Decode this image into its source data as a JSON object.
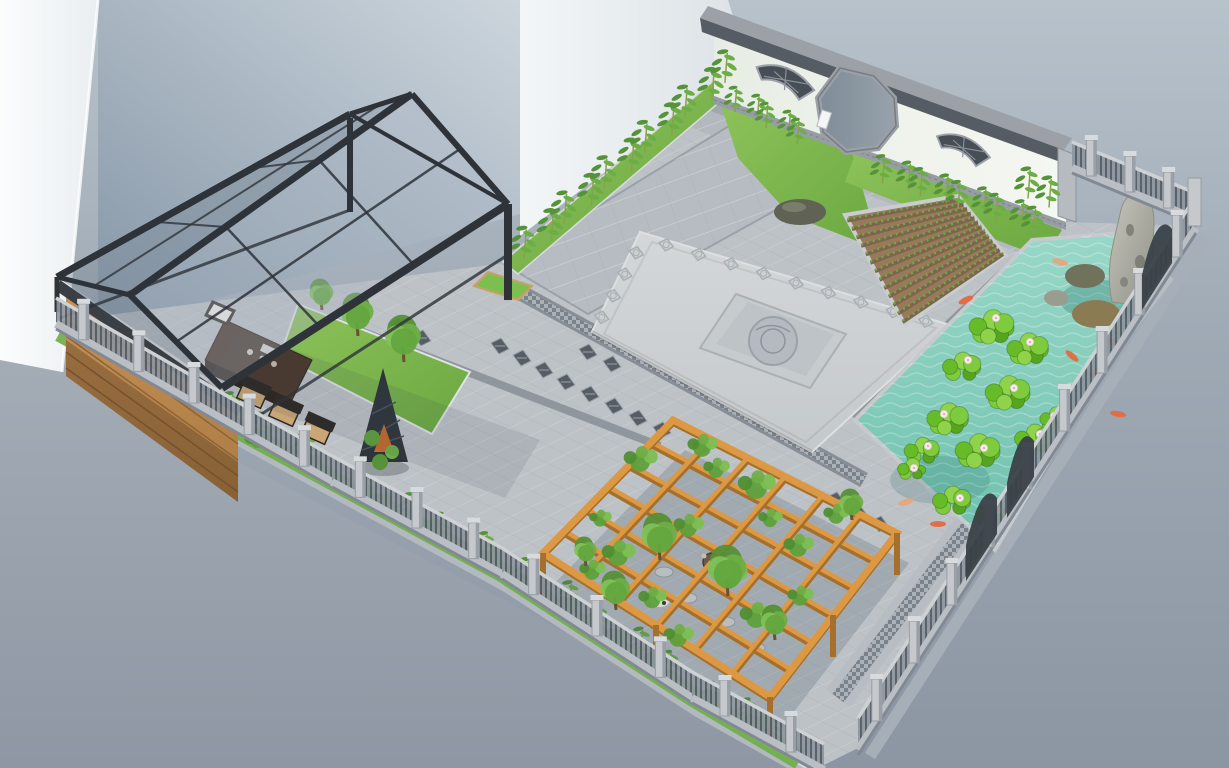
{
  "colors": {
    "sky_top": "#b8c2cb",
    "sky_bottom": "#8c96a3",
    "outside_ground": "#9aa3ae",
    "building_white": "#f4f8f8",
    "building_shade": "#8495a6",
    "building_light": "#edf1f3",
    "wall_white": "#eef3ec",
    "wall_coping": "#565c63",
    "wall_coping_top": "#9ba1a6",
    "brick_base": "#969da3",
    "window_lattice_dark": "#474e56",
    "gate_inner": "#8a96a2",
    "paving_base": "#bdc2c7",
    "paving_path": "#b3b9be",
    "paving_dark_band": "#878e96",
    "plaza_light": "#ced2d5",
    "medallion": "#b4bac0",
    "soil_brown": "#97795c",
    "seedling_green": "#6faa43",
    "grass_green": "#7cb94e",
    "grass_dark": "#55923a",
    "water_light": "#9ad8c8",
    "water_dark": "#6fc0ae",
    "lily_green": "#7ecb3d",
    "lily_dark": "#57a51f",
    "flower_white": "#f7f4ef",
    "flower_pink": "#eba7b5",
    "koi_orange": "#e06a40",
    "koi_pale": "#e8a57c",
    "rock_gray": "#b2b1a6",
    "rock_moss": "#70725c",
    "rock_brown": "#8a7b52",
    "fence_post": "#c5c9cd",
    "fence_infill": "#8d959e",
    "fence_rail": "#ced2d5",
    "fence_panel_dark": "#3a4148",
    "pergola_wood": "#dc9843",
    "pergola_wood_dark": "#a5702c",
    "vine_green": "#5fa03c",
    "tree_green": "#6fae47",
    "canopy_frame": "#2e3339",
    "wood_wall": "#c08b55",
    "wood_slat": "#8e6336",
    "table_brown": "#4a382b",
    "cushion_tan": "#c9a674",
    "bamboo_leaf": "#6cae45",
    "bamboo_leaf2": "#55923a",
    "bamboo_stem": "#8aa04f",
    "cone_trellis": "#2e343a",
    "cone_orange": "#c56a2b"
  },
  "scene_elements": {
    "bamboo_strips": [
      {
        "from": [
          517,
          268
        ],
        "to": [
          738,
          74
        ],
        "n": 11,
        "s": 1.15
      },
      {
        "from": [
          730,
          108
        ],
        "to": [
          808,
          148
        ],
        "n": 5,
        "s": 0.9
      },
      {
        "from": [
          876,
          180
        ],
        "to": [
          1046,
          238
        ],
        "n": 9,
        "s": 1.0
      },
      {
        "from": [
          1024,
          194
        ],
        "to": [
          1052,
          212
        ],
        "n": 2,
        "s": 1.1
      },
      {
        "from": [
          96,
          352
        ],
        "to": [
          320,
          474
        ],
        "n": 6,
        "s": 1.1
      },
      {
        "from": [
          350,
          492
        ],
        "to": [
          500,
          570
        ],
        "n": 4,
        "s": 1.0
      },
      {
        "from": [
          512,
          576
        ],
        "to": [
          690,
          692
        ],
        "n": 5,
        "s": 1.05
      },
      {
        "from": [
          700,
          700
        ],
        "to": [
          788,
          750
        ],
        "n": 3,
        "s": 0.95
      }
    ],
    "shrubs": [
      [
        140,
        380
      ],
      [
        200,
        414
      ],
      [
        258,
        446
      ],
      [
        308,
        470
      ],
      [
        378,
        508
      ],
      [
        428,
        534
      ],
      [
        468,
        556
      ],
      [
        528,
        590
      ],
      [
        568,
        612
      ],
      [
        618,
        644
      ],
      [
        658,
        668
      ],
      [
        718,
        706
      ],
      [
        758,
        730
      ],
      [
        360,
        500
      ],
      [
        488,
        566
      ],
      [
        96,
        360
      ]
    ],
    "trees": [
      [
        358,
        336,
        22
      ],
      [
        404,
        362,
        24
      ],
      [
        322,
        310,
        16
      ],
      [
        660,
        560,
        24
      ],
      [
        728,
        596,
        26
      ],
      [
        616,
        610,
        20
      ],
      [
        775,
        640,
        18
      ],
      [
        852,
        520,
        16
      ],
      [
        586,
        566,
        15
      ]
    ],
    "pergola": {
      "corners": [
        [
          673,
          420
        ],
        [
          897,
          533
        ],
        [
          770,
          697
        ],
        [
          543,
          553
        ]
      ],
      "cells": 6,
      "posts": [
        [
          543,
          553,
          46
        ],
        [
          770,
          697,
          44
        ],
        [
          897,
          533,
          42
        ],
        [
          656,
          625,
          44
        ],
        [
          833,
          615,
          42
        ]
      ]
    },
    "vines": [
      [
        640,
        462,
        18
      ],
      [
        702,
        448,
        16
      ],
      [
        756,
        488,
        20
      ],
      [
        688,
        528,
        16
      ],
      [
        618,
        556,
        18
      ],
      [
        728,
        578,
        20
      ],
      [
        798,
        548,
        16
      ],
      [
        836,
        516,
        14
      ],
      [
        756,
        618,
        18
      ],
      [
        678,
        638,
        16
      ],
      [
        592,
        572,
        14
      ],
      [
        716,
        470,
        14
      ],
      [
        652,
        600,
        15
      ],
      [
        800,
        598,
        14
      ],
      [
        770,
        520,
        13
      ],
      [
        600,
        520,
        12
      ]
    ],
    "lily_clusters": [
      [
        992,
        328,
        26
      ],
      [
        1028,
        350,
        24
      ],
      [
        962,
        368,
        22
      ],
      [
        1008,
        394,
        26
      ],
      [
        948,
        420,
        24
      ],
      [
        922,
        452,
        20
      ],
      [
        978,
        452,
        26
      ],
      [
        1034,
        440,
        22
      ],
      [
        952,
        502,
        22
      ],
      [
        992,
        514,
        18
      ],
      [
        912,
        470,
        16
      ],
      [
        1056,
        420,
        18
      ]
    ],
    "lily_flowers": [
      [
        996,
        318
      ],
      [
        1030,
        342
      ],
      [
        968,
        360
      ],
      [
        1014,
        388
      ],
      [
        944,
        414
      ],
      [
        928,
        446
      ],
      [
        984,
        448
      ],
      [
        1040,
        434
      ],
      [
        960,
        498
      ],
      [
        998,
        510
      ],
      [
        914,
        468
      ],
      [
        1054,
        416
      ]
    ],
    "koi": [
      [
        1060,
        262,
        15,
        1
      ],
      [
        1092,
        322,
        -10,
        0
      ],
      [
        1112,
        342,
        25,
        0
      ],
      [
        1072,
        356,
        40,
        0
      ],
      [
        1096,
        372,
        -30,
        0
      ],
      [
        1118,
        414,
        10,
        0
      ],
      [
        938,
        524,
        0,
        0
      ],
      [
        906,
        502,
        -15,
        1
      ],
      [
        1024,
        470,
        20,
        0
      ],
      [
        966,
        300,
        -25,
        0
      ]
    ],
    "tile_clusters": [
      [
        500,
        346
      ],
      [
        522,
        358
      ],
      [
        544,
        370
      ],
      [
        566,
        382
      ],
      [
        590,
        394
      ],
      [
        614,
        406
      ],
      [
        638,
        418
      ],
      [
        588,
        352
      ],
      [
        612,
        364
      ],
      [
        398,
        326
      ],
      [
        422,
        338
      ],
      [
        836,
        500
      ],
      [
        858,
        512
      ],
      [
        880,
        524
      ],
      [
        662,
        430
      ],
      [
        700,
        446
      ]
    ],
    "border_tile_rows": [
      {
        "from": [
          650,
          240
        ],
        "to": [
          942,
          326
        ],
        "n": 9
      },
      {
        "from": [
          642,
          242
        ],
        "to": [
          596,
          328
        ],
        "n": 4
      }
    ],
    "veg_plot": {
      "corners": [
        [
          845,
          215
        ],
        [
          958,
          196
        ],
        [
          1005,
          255
        ],
        [
          905,
          325
        ]
      ],
      "rows": 13
    },
    "fences": {
      "rear": [
        {
          "p1": [
            1072,
            166
          ],
          "p2": [
            1188,
            214
          ],
          "h": 24,
          "posts": 3
        },
        {
          "p1": [
            1196,
            226
          ],
          "p2": [
            858,
            748
          ],
          "h": 30,
          "posts": 9
        }
      ],
      "front": [
        {
          "p1": [
            56,
            322
          ],
          "p2": [
            332,
            480
          ],
          "h": 24,
          "posts": 5
        },
        {
          "p1": [
            332,
            480
          ],
          "p2": [
            502,
            572
          ],
          "h": 24,
          "posts": 3
        },
        {
          "p1": [
            502,
            572
          ],
          "p2": [
            692,
            696
          ],
          "h": 24,
          "posts": 3
        },
        {
          "p1": [
            692,
            696
          ],
          "p2": [
            824,
            768
          ],
          "h": 24,
          "posts": 2
        }
      ]
    },
    "stepping_stones": [
      [
        688,
        598
      ],
      [
        726,
        622
      ],
      [
        664,
        572
      ],
      [
        756,
        648
      ]
    ]
  }
}
